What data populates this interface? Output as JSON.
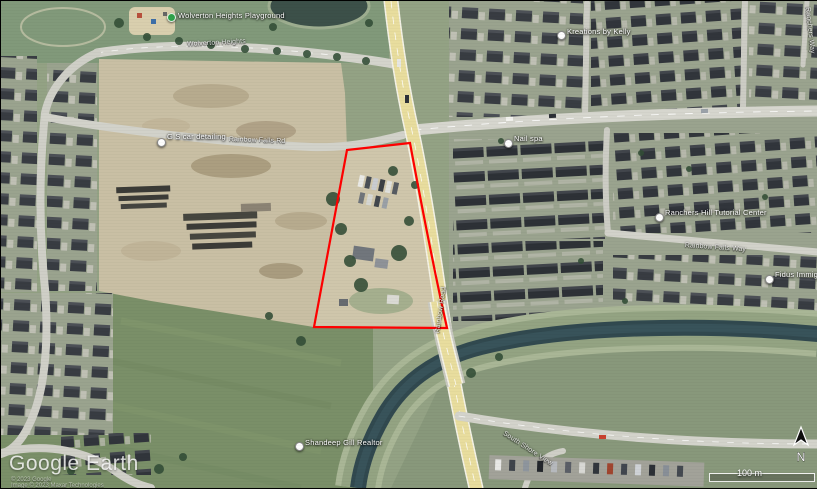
{
  "pois": {
    "playground": {
      "label": "Wolverton Heights Playground"
    },
    "kreations": {
      "label": "Kreations by Kelly"
    },
    "car_detailing": {
      "label": "G S car detailing"
    },
    "nail_spa": {
      "label": "Nail spa"
    },
    "tutorial": {
      "label": "Ranchers Hill Tutorial Center"
    },
    "fidus": {
      "label": "Fidus Immigra"
    },
    "realtor": {
      "label": "Shandeep Gill Realtor"
    }
  },
  "streets": {
    "wolverton": "Wolverton Heights",
    "rainbow_falls_rd": "Rainbow Falls Rd",
    "rainbow_falls_way": "Rainbow Falls Way",
    "rainbow_road": "Rainbow Road",
    "ranchers_way": "Ranchers Way",
    "south_shore": "South Shore View"
  },
  "hud": {
    "watermark": "Google Earth",
    "attribution_line1": "© 2023 Google",
    "attribution_line2": "Image © 2023 Maxar Technologies",
    "scale_label": "100 m",
    "compass_label": "N"
  },
  "colors": {
    "parcel_outline": "#ff0000",
    "highway_fill": "#e8dd9e",
    "canal_water": "#31494f"
  }
}
